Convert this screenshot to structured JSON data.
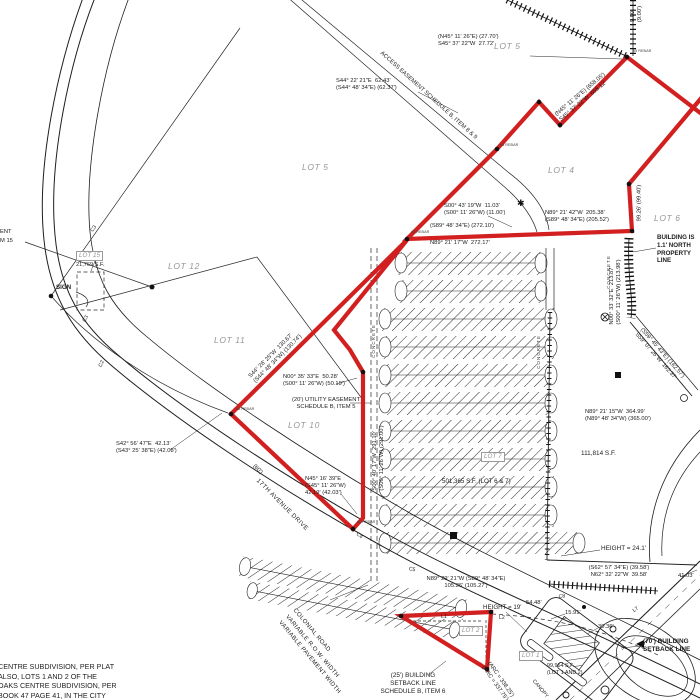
{
  "colors": {
    "boundary_red": "#d22020",
    "linework_black": "#1a1a1a",
    "lot_label_gray": "#979797"
  },
  "labels": {
    "lot5_top": "LOT 5",
    "lot5_mid": "LOT 5",
    "lot4": "LOT 4",
    "lot6": "LOT 6",
    "lot12": "LOT 12",
    "lot11": "LOT 11",
    "lot10": "LOT 10",
    "lot15": "LOT 15",
    "lot7": "LOT 7",
    "lot2": "LOT 2",
    "lot1": "LOT 1",
    "apex_bearing": "(N45° 11' 26\"E) (27.70')\nS45° 37' 22\"W  27.72'",
    "notch_bearing": "S44° 22' 21\"E  62.43'\n(S44° 48' 34\"E) (62.37')",
    "access_easement": "ACCESS EASEMENT SCHEDULE B, ITEM 8 & 9",
    "long_diag_bearing": "(N45° 11' 26\"E) (658.05')\nS45° 37' 22\"W  658.12'",
    "s00_43_19": "S00° 43' 19\"W  11.03'\n(S00° 11' 26\"W) (11.00')",
    "n89_21_42": "N89° 21' 42\"W  205.38'\n(S89° 48' 34\"E) (205.52')",
    "s89_48_34": "(S89° 48' 34\"E) (272.10')",
    "n89_21_17": "N89° 21' 17\"W  272.17'",
    "building_north": "BUILDING IS\n1.1' NORTH\nPROPERTY\nLINE",
    "n00_33_32": "N00° 33' 32\"E  213.87'\n(S00° 11' 26\"W) (213.98')",
    "seg_99": "99.26' (99.40')",
    "s59_07": "(S59° 45' 43\"E) (162.57')\nS59° 07' 26\"W  162.37'",
    "n89_21_15": "N89° 21' 15\"W  364.99'\n(N89° 48' 34\"W) (365.00')",
    "area_111814": "111,814 S.F.",
    "area_501365": "501,365 S.F. (LOT 6 & 7)",
    "area_21769": "21,769 S.F.",
    "area_99964": "99,964 S.F.\n(LOT 1 AND 2)",
    "n00_35_33": "N00° 35' 33\"E  50.28'\n(S00° 11' 26\"W) (50.19')",
    "utility_easement": "(20') UTILITY EASEMENT\nSCHEDULE B, ITEM 5",
    "n45_16_39": "N45° 16' 39\"E\n(S45° 11' 26\"W)\n42.19' (42.03')",
    "s42_56_47": "S42° 56' 47\"E  42.13'\n(S43° 25' 38\"E) (42.08')",
    "s44_26_25": "S44° 26' 25\"W  130.67'\n(S44° 48' 34\"W) (130.74')",
    "s00_40_17": "S00° 40' 17\"W  291.10'\n(S00° 11' 26\"W) (291.00')",
    "sign": "SIGN",
    "ent_cut": "ENT",
    "item15_cut": "M 15",
    "road_width": "(60')",
    "seventeenth_ave": "17TH AVENUE DRIVE",
    "colonial_road": "COLONIAL ROAD\nVARIABLE R.O.W. WIDTH\nVARIABLE PAVEMENT WIDTH",
    "subdivision_note": "CENTRE SUBDIVISION, PER PLAT\nALSO, LOTS 1 AND 2 OF THE\nOAKS CENTRE SUBDIVISION, PER\nBOOK 47 PAGE 41, IN THE CITY",
    "setback_25": "(25') BUILDING\nSETBACK LINE\nSCHEDULE B, ITEM 6",
    "setback_70": "(70') BUILDING\nSETBACK LINE",
    "height_241": "HEIGHT = 24.1'",
    "height_19": "HEIGHT = 19'",
    "n62_32_22": "(S62° 57' 34\"E) (39.58')\nN62° 32' 22\"W  39.58'",
    "n89_29_21": "N89° 29' 21\"W (S89° 48' 34\"E)\n105.26' (105.27')",
    "arc_338": "(ARC = 338.25')\n(ARC = 337.75')",
    "canopy": "CANOPY",
    "dim_5448": "54.48'",
    "dim_1591": "15.91'",
    "dim_3036": "30.36'",
    "dim_4103": "41.03'",
    "dim_900": "9.00'\n(9.00')",
    "concrete": "CONCRETE",
    "curve_c2": "C2",
    "curve_c3": "C3",
    "curve_c4": "C4",
    "curve_c5": "C5",
    "curve_c8": "C8",
    "line_l1": "L1",
    "line_l2": "L2",
    "line_l7": "L7",
    "rebar": "#5 REBAR"
  }
}
